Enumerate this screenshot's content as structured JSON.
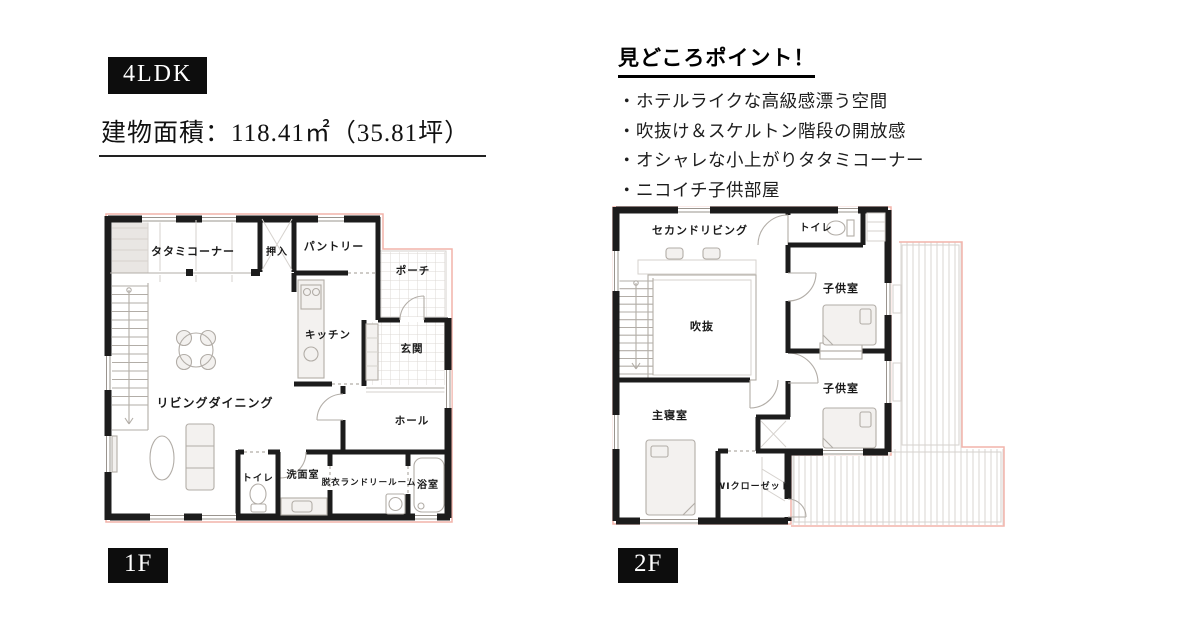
{
  "header": {
    "type_label": "4LDK",
    "area_label": "建物面積：118.41㎡（35.81坪）"
  },
  "highlights": {
    "title": "見どころポイント！",
    "items": [
      "・ホテルライクな高級感漂う空間",
      "・吹抜け＆スケルトン階段の開放感",
      "・オシャレな小上がりタタミコーナー",
      "・ニコイチ子供部屋"
    ]
  },
  "floor1": {
    "badge": "1F",
    "rooms": {
      "tatami": "タタミコーナー",
      "oshiire": "押入",
      "pantry": "パントリー",
      "porch": "ポーチ",
      "kitchen": "キッチン",
      "genkan": "玄関",
      "living": "リビングダイニング",
      "hall": "ホール",
      "toilet": "トイレ",
      "washroom": "洗面室",
      "laundry": "脱衣ランドリールーム",
      "bath": "浴室"
    }
  },
  "floor2": {
    "badge": "2F",
    "rooms": {
      "second_living": "セカンドリビング",
      "toilet": "トイレ",
      "kids_room_1": "子供室",
      "kids_room_2": "子供室",
      "void": "吹抜",
      "master": "主寝室",
      "wic": "WIクローゼット"
    }
  },
  "colors": {
    "wall": "#1c1c1c",
    "outline_pink": "#f2b3aa",
    "badge_bg": "#0d0d0d",
    "badge_text": "#ffffff",
    "text": "#1a1a1a"
  }
}
